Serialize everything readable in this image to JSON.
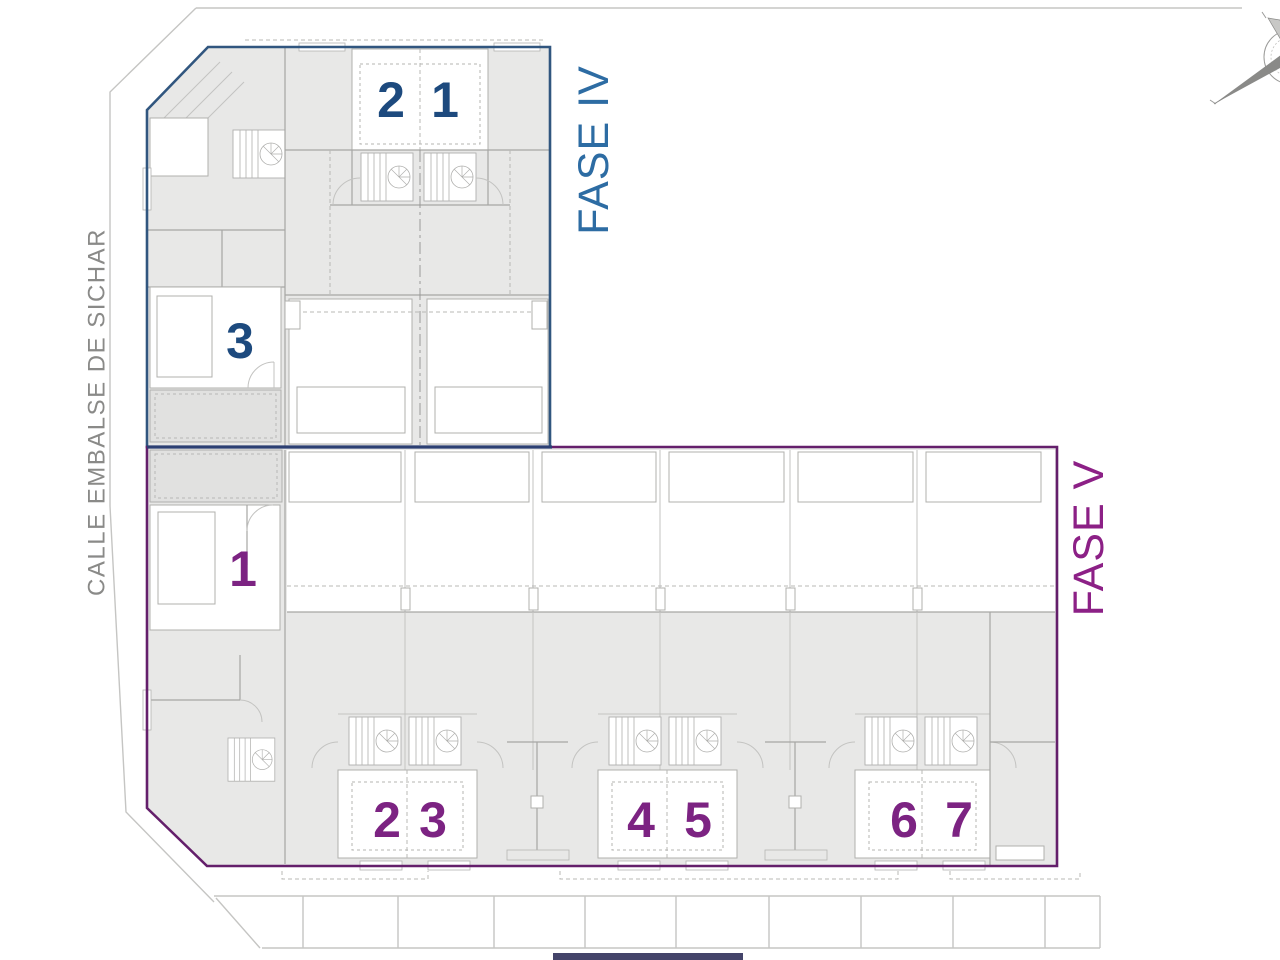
{
  "street": {
    "label": "CALLE EMBALSE DE SICHAR",
    "color": "#8a8a88"
  },
  "fase4": {
    "label": "FASE IV",
    "label_color": "#2d6ca3",
    "boundary_color": "#31567f",
    "shared_edge_color": "#2c3f72",
    "number_color": "#1d4a7e",
    "units": [
      "2",
      "1",
      "3"
    ]
  },
  "fase5": {
    "label": "FASE V",
    "label_color": "#8c2086",
    "boundary_color": "#641f6b",
    "number_color": "#7c2382",
    "units": [
      "1",
      "2",
      "3",
      "4",
      "5",
      "6",
      "7"
    ]
  },
  "icons": {
    "compass": "compass-rose",
    "stairs": "staircase-symbol"
  }
}
